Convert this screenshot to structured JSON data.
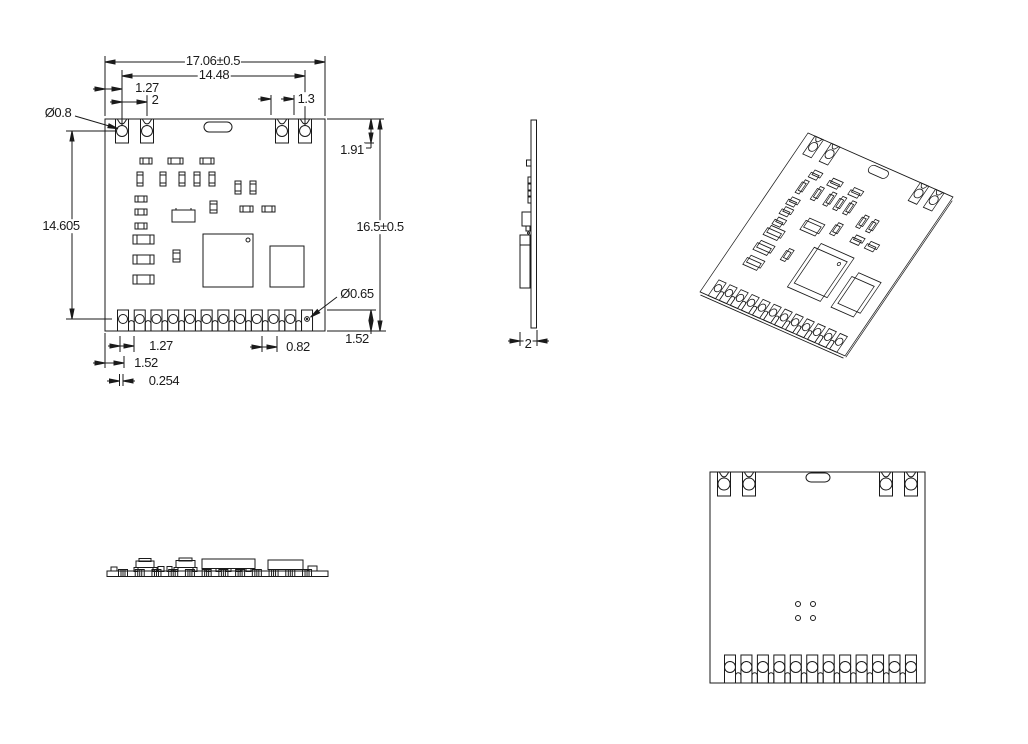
{
  "drawing_type": "mechanical-dimension-drawing",
  "colors": {
    "background": "#ffffff",
    "line": "#1a1a1a",
    "text": "#1a1a1a"
  },
  "views": {
    "front": {
      "top_pads": 4,
      "bottom_pads": 12,
      "dimensions": {
        "overall_width": "17.06±0.5",
        "top_hole_span": "14.48",
        "left_edge_to_hole": "1.27",
        "top_hole_pitch": "2",
        "right_hole_to_edge": "1.3",
        "top_hole_diameter": "Ø0.8",
        "top_pad_height": "1.91",
        "overall_height": "16.5±0.5",
        "vertical_hole_span": "14.605",
        "bottom_hole_diameter": "Ø0.65",
        "bottom_pad_height": "1.52",
        "bottom_pad_pitch": "1.27",
        "bottom_pad_width": "0.82",
        "left_edge_to_pad": "1.52",
        "pad_gap": "0.254"
      }
    },
    "side": {
      "dimensions": {
        "thickness": "2"
      }
    },
    "isometric": {
      "top_pads": 4,
      "bottom_pads": 12
    },
    "bottom_edge": {
      "pad_count": 12
    },
    "back": {
      "top_pads": 4,
      "bottom_pads": 12,
      "via_count": 4
    }
  }
}
